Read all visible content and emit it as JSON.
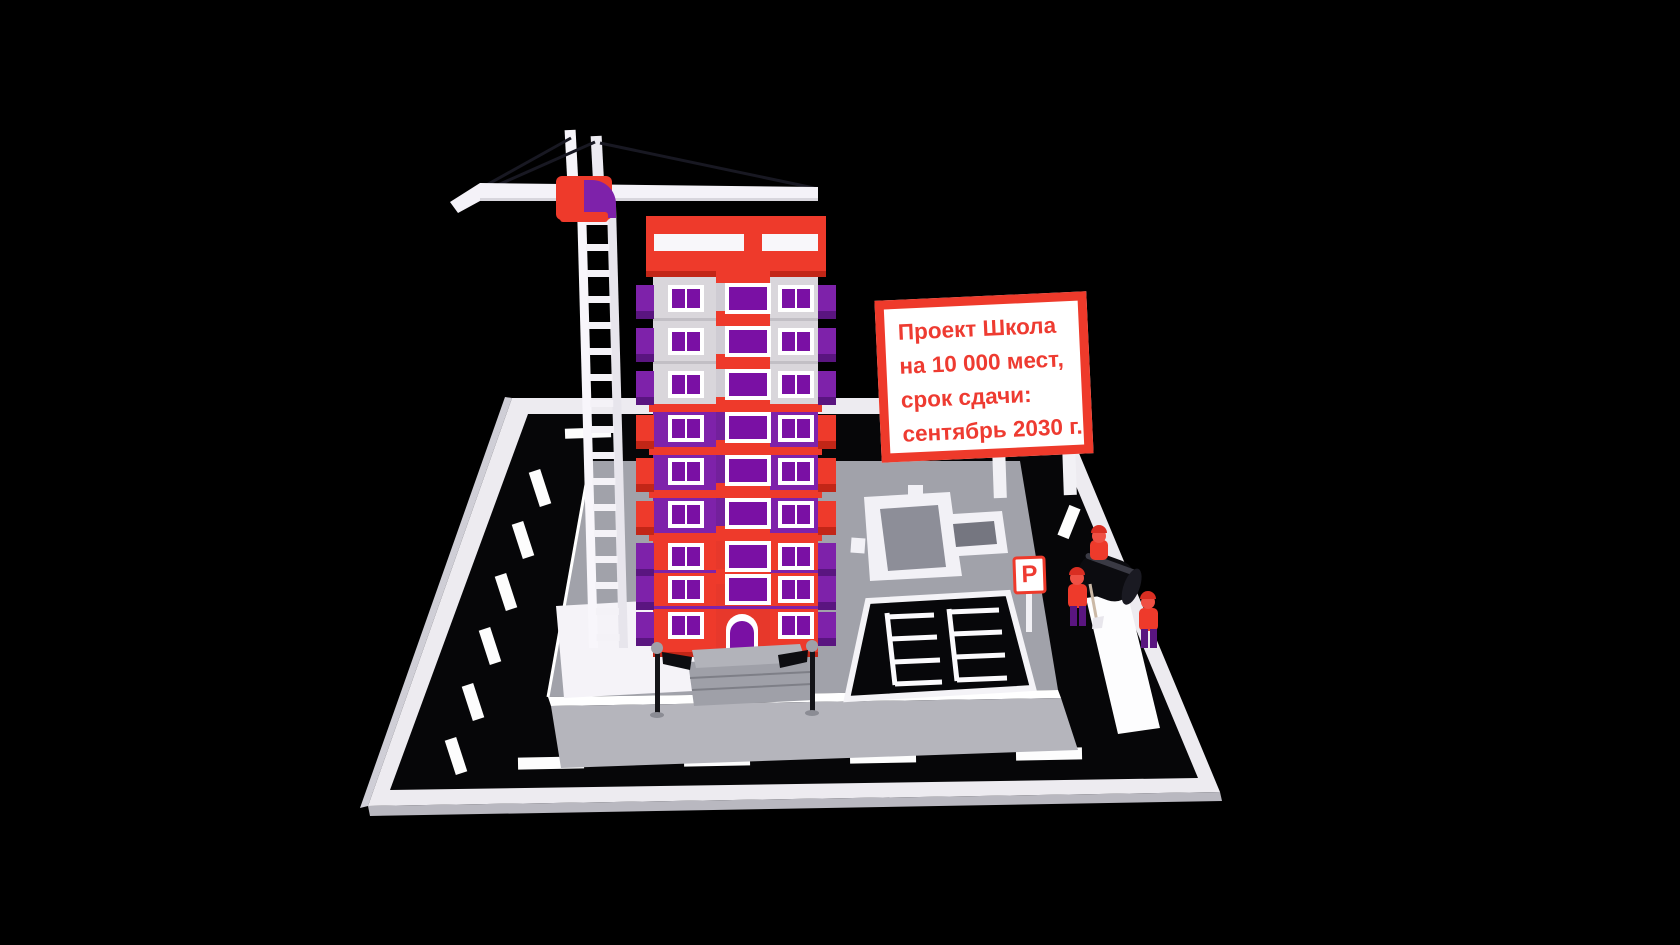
{
  "scene": {
    "billboard": {
      "lines": [
        "Проект Школа",
        "на 10 000 мест,",
        "срок сдачи:",
        "сентябрь 2030 г."
      ]
    },
    "parking_sign": {
      "letter": "P"
    },
    "palette": {
      "background": "#000000",
      "red": "#ee3a2b",
      "red_dark": "#c22617",
      "purple": "#7e22aa",
      "purple_dark": "#5a1580",
      "window_purple": "#7a10a4",
      "wall_gray": "#d9d6db",
      "site_gray": "#a1a2aa",
      "apron_gray": "#b5b5bc",
      "road_black": "#060608",
      "slab_white": "#edebf0",
      "white": "#ffffff",
      "sign_text_red": "#ee3b31"
    }
  }
}
